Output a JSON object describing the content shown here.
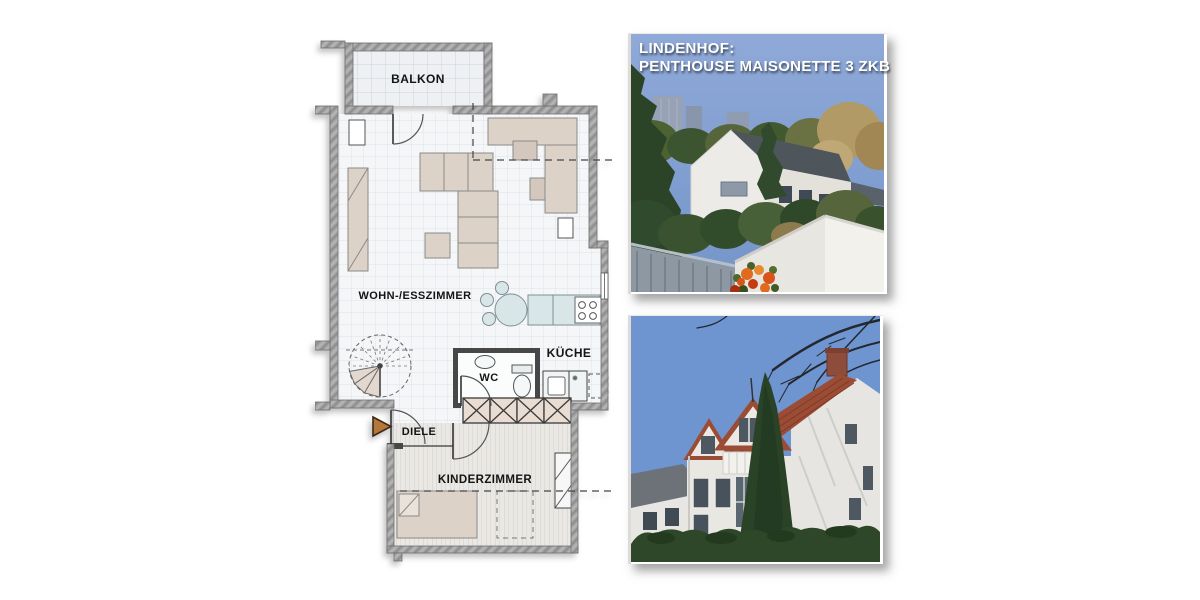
{
  "page": {
    "background": "#ffffff"
  },
  "headline": {
    "line1": "LINDENHOF:",
    "line2": "PENTHOUSE MAISONETTE 3 ZKB",
    "text_color": "#ffffff"
  },
  "floor_plan": {
    "rooms": [
      {
        "id": "balkon",
        "label": "BALKON"
      },
      {
        "id": "wohn_esszimmer",
        "label": "WOHN-/ESSZIMMER"
      },
      {
        "id": "kueche",
        "label": "KÜCHE"
      },
      {
        "id": "wc",
        "label": "WC"
      },
      {
        "id": "diele",
        "label": "DIELE"
      },
      {
        "id": "kinderzimmer",
        "label": "KINDERZIMMER"
      }
    ],
    "entrance_marker_icon": "entrance-arrow",
    "colors": {
      "wall": "#a6a6a6",
      "furniture": "#ddd2c8",
      "kitchen_fixture": "#d9e6e8",
      "entrance_arrow": "#b5763a"
    }
  },
  "photos": {
    "top": {
      "name": "balcony-view-photo",
      "sky": "#84a3d5"
    },
    "bottom": {
      "name": "house-exterior-photo",
      "sky": "#6e95cf",
      "roof": "#9a4c34"
    }
  }
}
